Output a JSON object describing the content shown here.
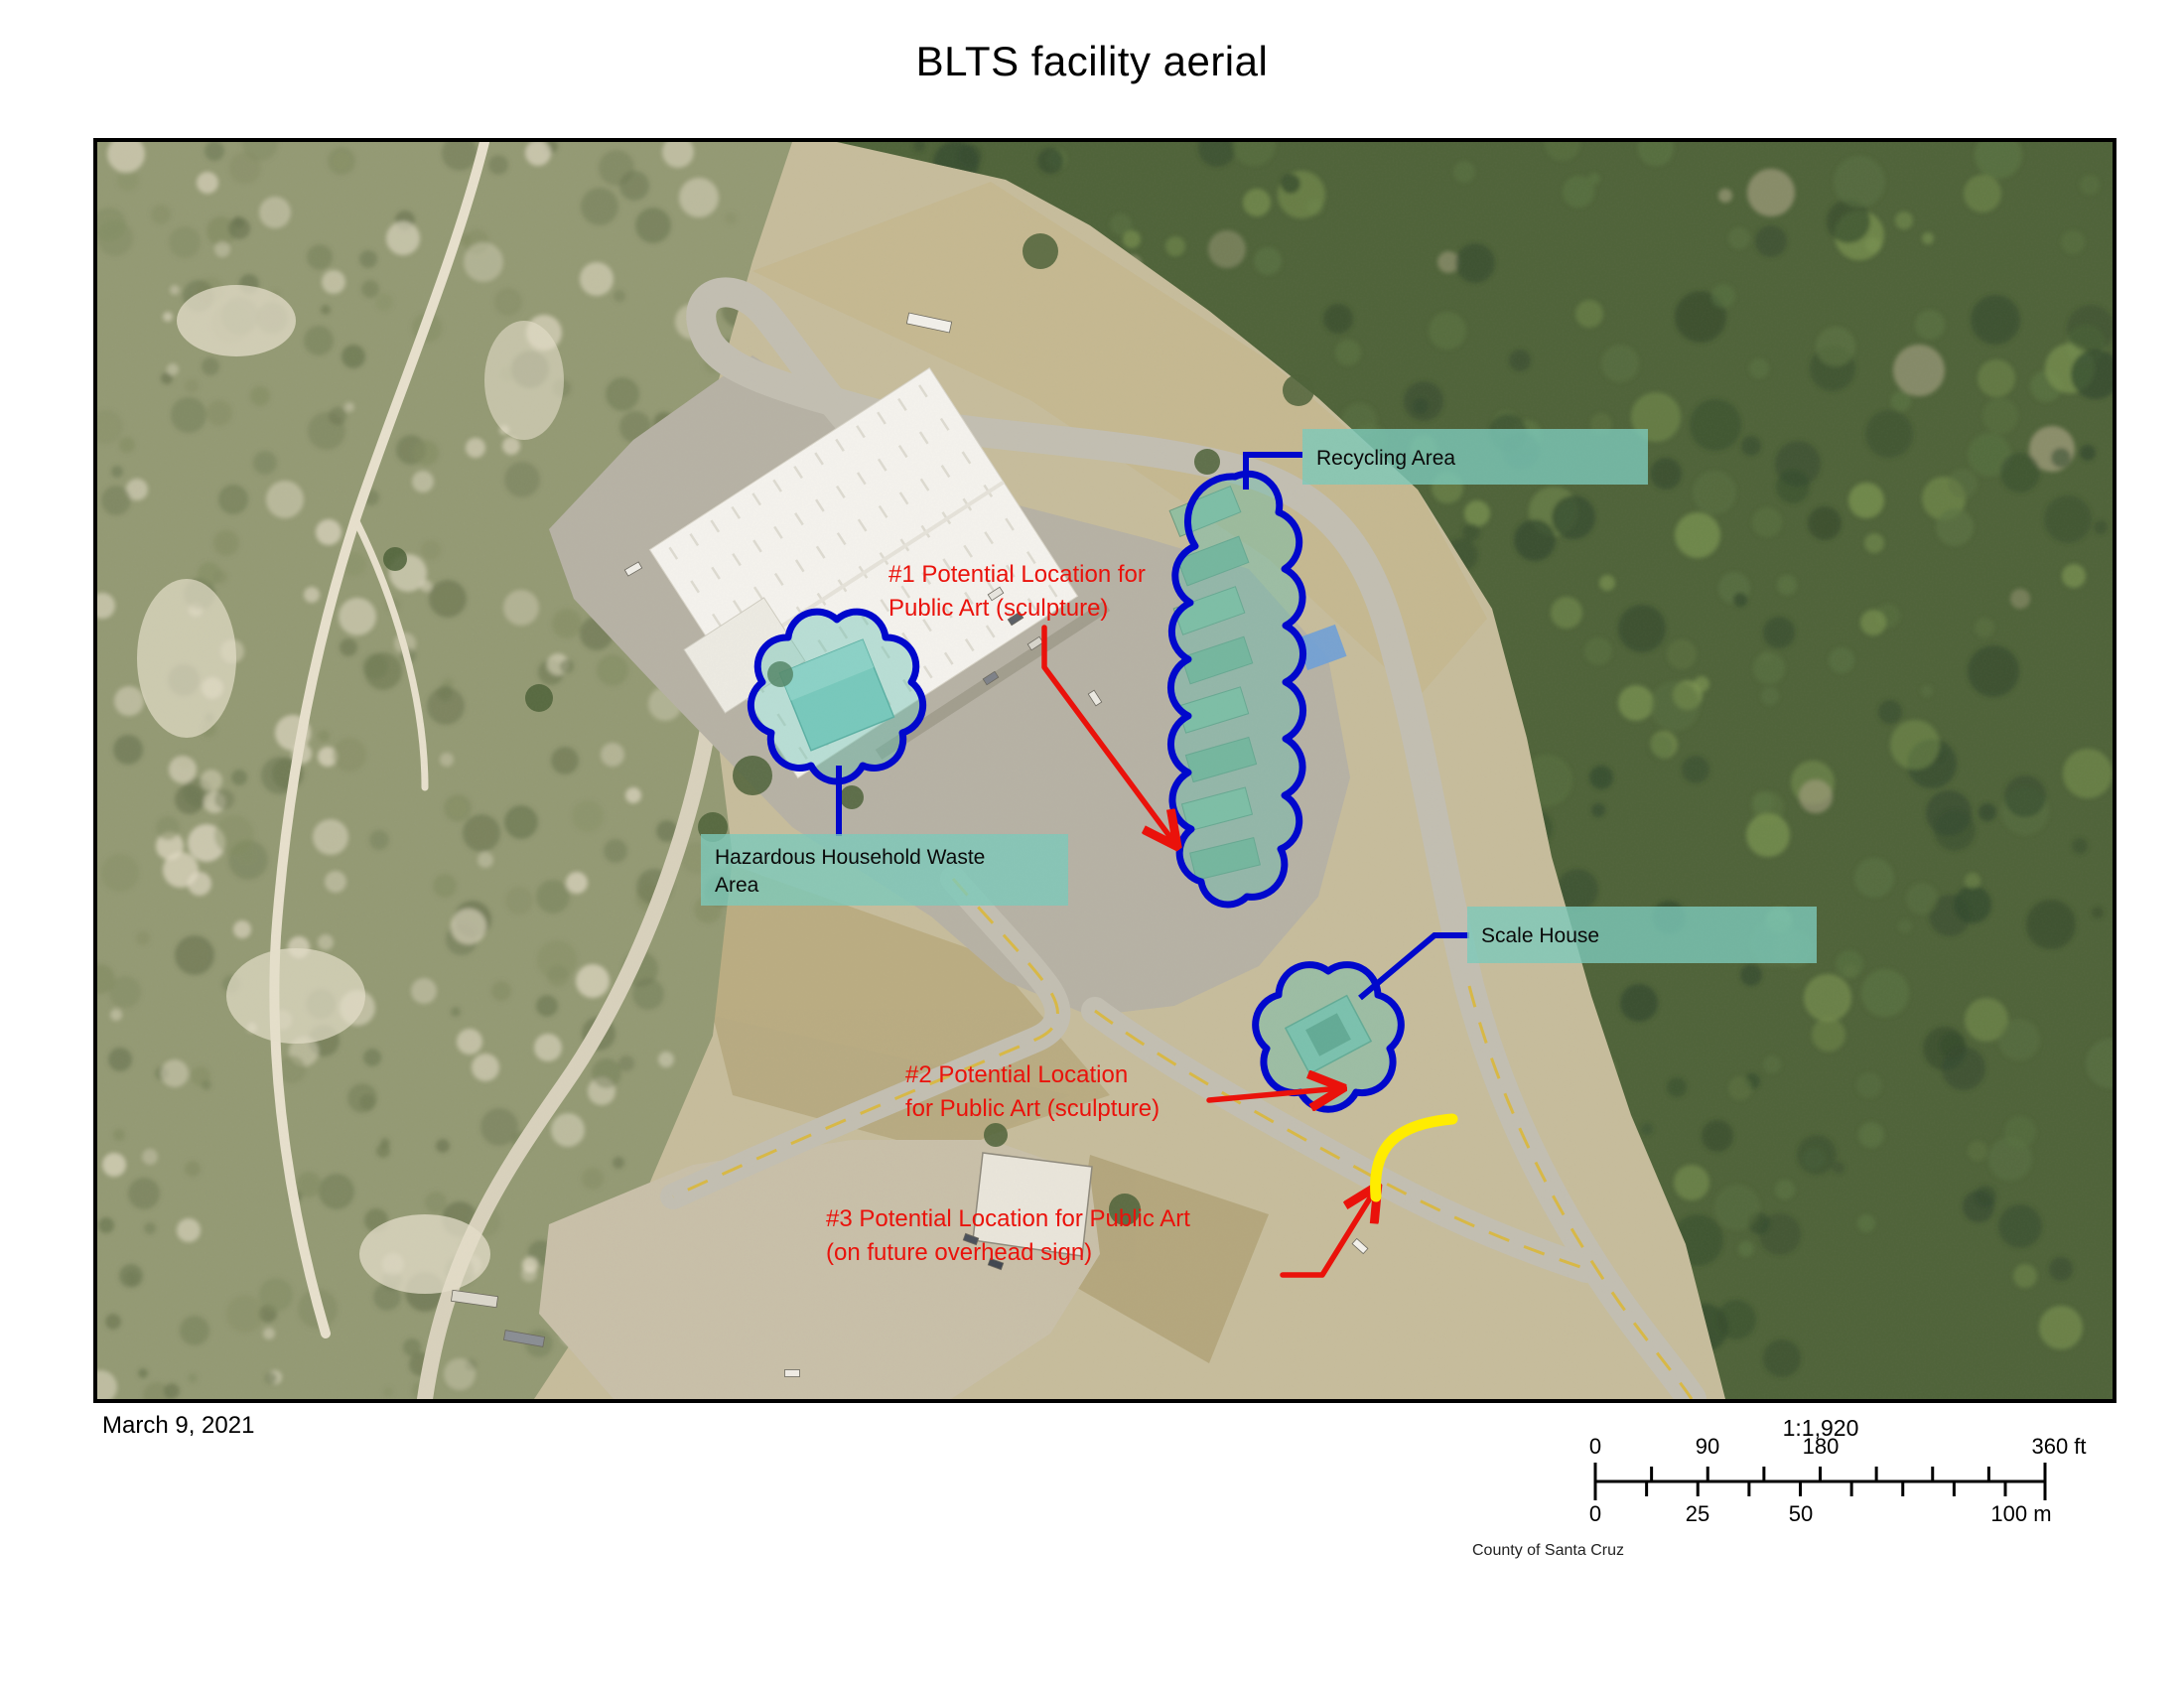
{
  "title": "BLTS facility aerial",
  "footer": {
    "date": "March 9, 2021",
    "credit": "County of Santa Cruz"
  },
  "scalebar": {
    "ratio": "1:1,920",
    "feet": [
      "0",
      "90",
      "180",
      "360 ft"
    ],
    "meters": [
      "0",
      "25",
      "50",
      "100 m"
    ]
  },
  "map": {
    "area_labels": {
      "recycling": "Recycling Area",
      "hhw": "Hazardous Household Waste",
      "hhw2": "Area",
      "scale_house": "Scale House"
    },
    "annotations": {
      "loc1_l1": "#1 Potential Location for",
      "loc1_l2": "Public Art (sculpture)",
      "loc2_l1": "#2 Potential Location",
      "loc2_l2": "for Public Art (sculpture)",
      "loc3_l1": "#3 Potential Location for Public Art",
      "loc3_l2": "(on future overhead sign)"
    },
    "colors": {
      "cloud_blue": "#0008cc",
      "annotation_red": "#ea120b",
      "label_teal": "#7dc9ba",
      "highlight_yellow": "#ffec00"
    }
  }
}
